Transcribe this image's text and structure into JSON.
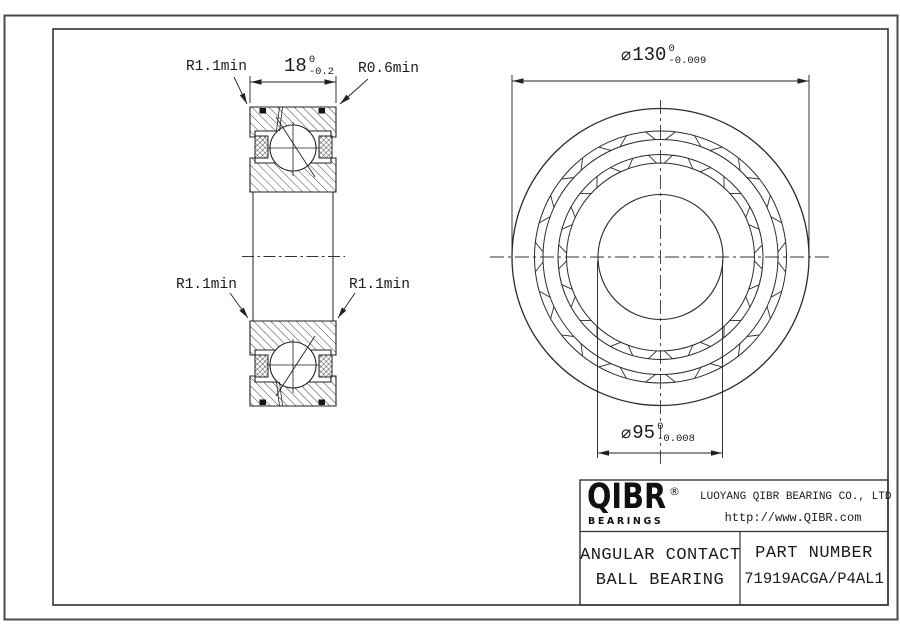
{
  "dimensions": {
    "width": {
      "value": "18",
      "tol_upper": "0",
      "tol_lower": "-0.2"
    },
    "outer_diameter": {
      "symbol": "⌀",
      "value": "130",
      "tol_upper": "0",
      "tol_lower": "-0.009"
    },
    "bore_diameter": {
      "symbol": "⌀",
      "value": "95",
      "tol_upper": "0",
      "tol_lower": "-0.008"
    }
  },
  "radius_labels": {
    "top_left": "R1.1min",
    "top_right": "R0.6min",
    "mid_left": "R1.1min",
    "mid_right": "R1.1min"
  },
  "title_block": {
    "brand": "QIBR",
    "registered_mark": "®",
    "brand_sub": "BEARINGS",
    "company": "LUOYANG QIBR BEARING CO., LTD",
    "website": "http://www.QIBR.com",
    "product_line1": "ANGULAR CONTACT",
    "product_line2": "BALL BEARING",
    "part_number_label": "PART NUMBER",
    "part_number": "71919ACGA/P4AL1"
  },
  "colors": {
    "line": "#222222",
    "text": "#1b1b1b",
    "sheet_border": "#4a4a4a"
  }
}
